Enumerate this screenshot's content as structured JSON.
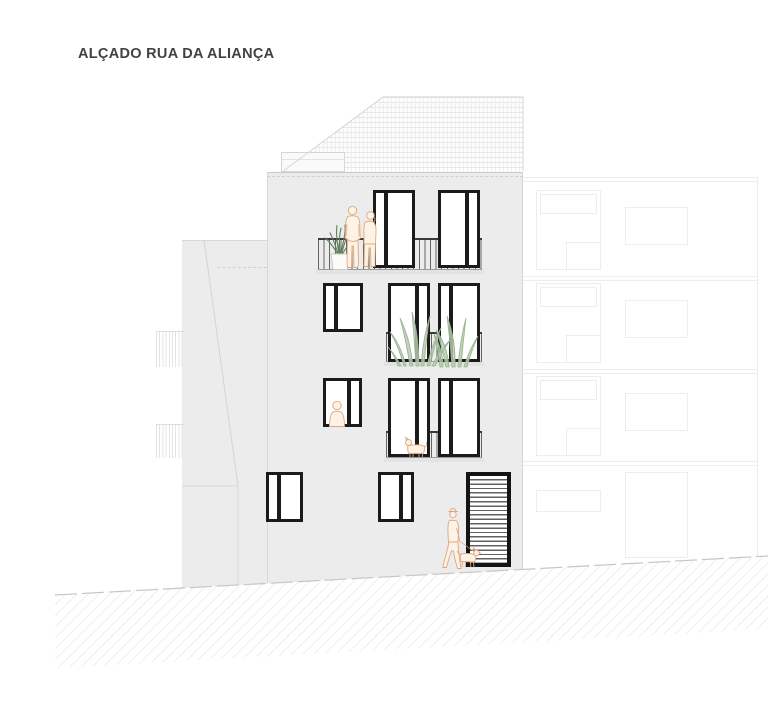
{
  "title": {
    "text": "ALÇADO RUA DA ALIANÇA"
  },
  "palette": {
    "facade": "#ececec",
    "window_frame": "#1b1b1b",
    "railing": "#4a4a4a",
    "figure_outline": "#dfa87c",
    "figure_fill": "#fdf2e6",
    "plant_dark": "#5d805d",
    "plant_light": "#b5caae",
    "ground_line": "#c6c6c6",
    "faint_line": "#ededed",
    "title_text": "#424242"
  },
  "drawing": {
    "windows": [
      {
        "id": "window-4f-left",
        "x": 373,
        "y": 190,
        "w": 42,
        "h": 78,
        "mullion": "left"
      },
      {
        "id": "window-4f-right",
        "x": 438,
        "y": 190,
        "w": 42,
        "h": 78,
        "mullion": "right"
      },
      {
        "id": "window-3f-small",
        "x": 323,
        "y": 283,
        "w": 40,
        "h": 49,
        "mullion": "left"
      },
      {
        "id": "window-3f-mid",
        "x": 388,
        "y": 283,
        "w": 42,
        "h": 79,
        "mullion": "right"
      },
      {
        "id": "window-3f-right",
        "x": 438,
        "y": 283,
        "w": 42,
        "h": 79,
        "mullion": "left"
      },
      {
        "id": "window-2f-small",
        "x": 323,
        "y": 378,
        "w": 39,
        "h": 49,
        "mullion": "right"
      },
      {
        "id": "window-2f-mid",
        "x": 388,
        "y": 378,
        "w": 42,
        "h": 79,
        "mullion": "right"
      },
      {
        "id": "window-2f-right",
        "x": 438,
        "y": 378,
        "w": 42,
        "h": 79,
        "mullion": "left"
      },
      {
        "id": "window-1f-left",
        "x": 266,
        "y": 472,
        "w": 37,
        "h": 50,
        "mullion": "left"
      },
      {
        "id": "window-1f-mid",
        "x": 378,
        "y": 472,
        "w": 36,
        "h": 50,
        "mullion": "right"
      }
    ],
    "door": {
      "id": "louvered-entrance-door",
      "x": 466,
      "y": 472,
      "w": 45,
      "h": 95
    },
    "railings": [
      {
        "x": 318,
        "y": 238,
        "w": 164,
        "h": 32
      },
      {
        "x": 386,
        "y": 332,
        "w": 96,
        "h": 30
      },
      {
        "x": 386,
        "y": 431,
        "w": 96,
        "h": 27
      }
    ],
    "slabs": [
      {
        "x": 316,
        "y": 270,
        "w": 168,
        "h": 4
      },
      {
        "x": 384,
        "y": 362,
        "w": 100,
        "h": 4
      },
      {
        "x": 384,
        "y": 458,
        "w": 100,
        "h": 4
      }
    ],
    "left_neighbor_railings": [
      {
        "x": 156,
        "y": 331,
        "w": 28,
        "h": 36
      },
      {
        "x": 156,
        "y": 424,
        "w": 28,
        "h": 34
      }
    ],
    "right_neighbor": {
      "floor_lines": [
        {
          "x": 523,
          "y": 177,
          "w": 234,
          "h": 1
        },
        {
          "x": 523,
          "y": 181,
          "w": 234,
          "h": 1
        },
        {
          "x": 523,
          "y": 276,
          "w": 234,
          "h": 1
        },
        {
          "x": 523,
          "y": 280,
          "w": 234,
          "h": 1
        },
        {
          "x": 523,
          "y": 369,
          "w": 234,
          "h": 1
        },
        {
          "x": 523,
          "y": 373,
          "w": 234,
          "h": 1
        },
        {
          "x": 523,
          "y": 461,
          "w": 234,
          "h": 1
        },
        {
          "x": 523,
          "y": 465,
          "w": 234,
          "h": 1
        },
        {
          "x": 757,
          "y": 177,
          "w": 1,
          "h": 383
        }
      ],
      "rects": [
        {
          "x": 536,
          "y": 190,
          "w": 65,
          "h": 80
        },
        {
          "x": 540,
          "y": 194,
          "w": 57,
          "h": 20
        },
        {
          "x": 566,
          "y": 242,
          "w": 35,
          "h": 28
        },
        {
          "x": 625,
          "y": 207,
          "w": 63,
          "h": 38
        },
        {
          "x": 536,
          "y": 283,
          "w": 65,
          "h": 80
        },
        {
          "x": 540,
          "y": 287,
          "w": 57,
          "h": 20
        },
        {
          "x": 566,
          "y": 335,
          "w": 35,
          "h": 28
        },
        {
          "x": 625,
          "y": 300,
          "w": 63,
          "h": 38
        },
        {
          "x": 536,
          "y": 376,
          "w": 65,
          "h": 80
        },
        {
          "x": 540,
          "y": 380,
          "w": 57,
          "h": 20
        },
        {
          "x": 566,
          "y": 428,
          "w": 35,
          "h": 28
        },
        {
          "x": 625,
          "y": 393,
          "w": 63,
          "h": 38
        },
        {
          "x": 536,
          "y": 490,
          "w": 65,
          "h": 22
        },
        {
          "x": 625,
          "y": 472,
          "w": 63,
          "h": 86
        }
      ]
    }
  }
}
